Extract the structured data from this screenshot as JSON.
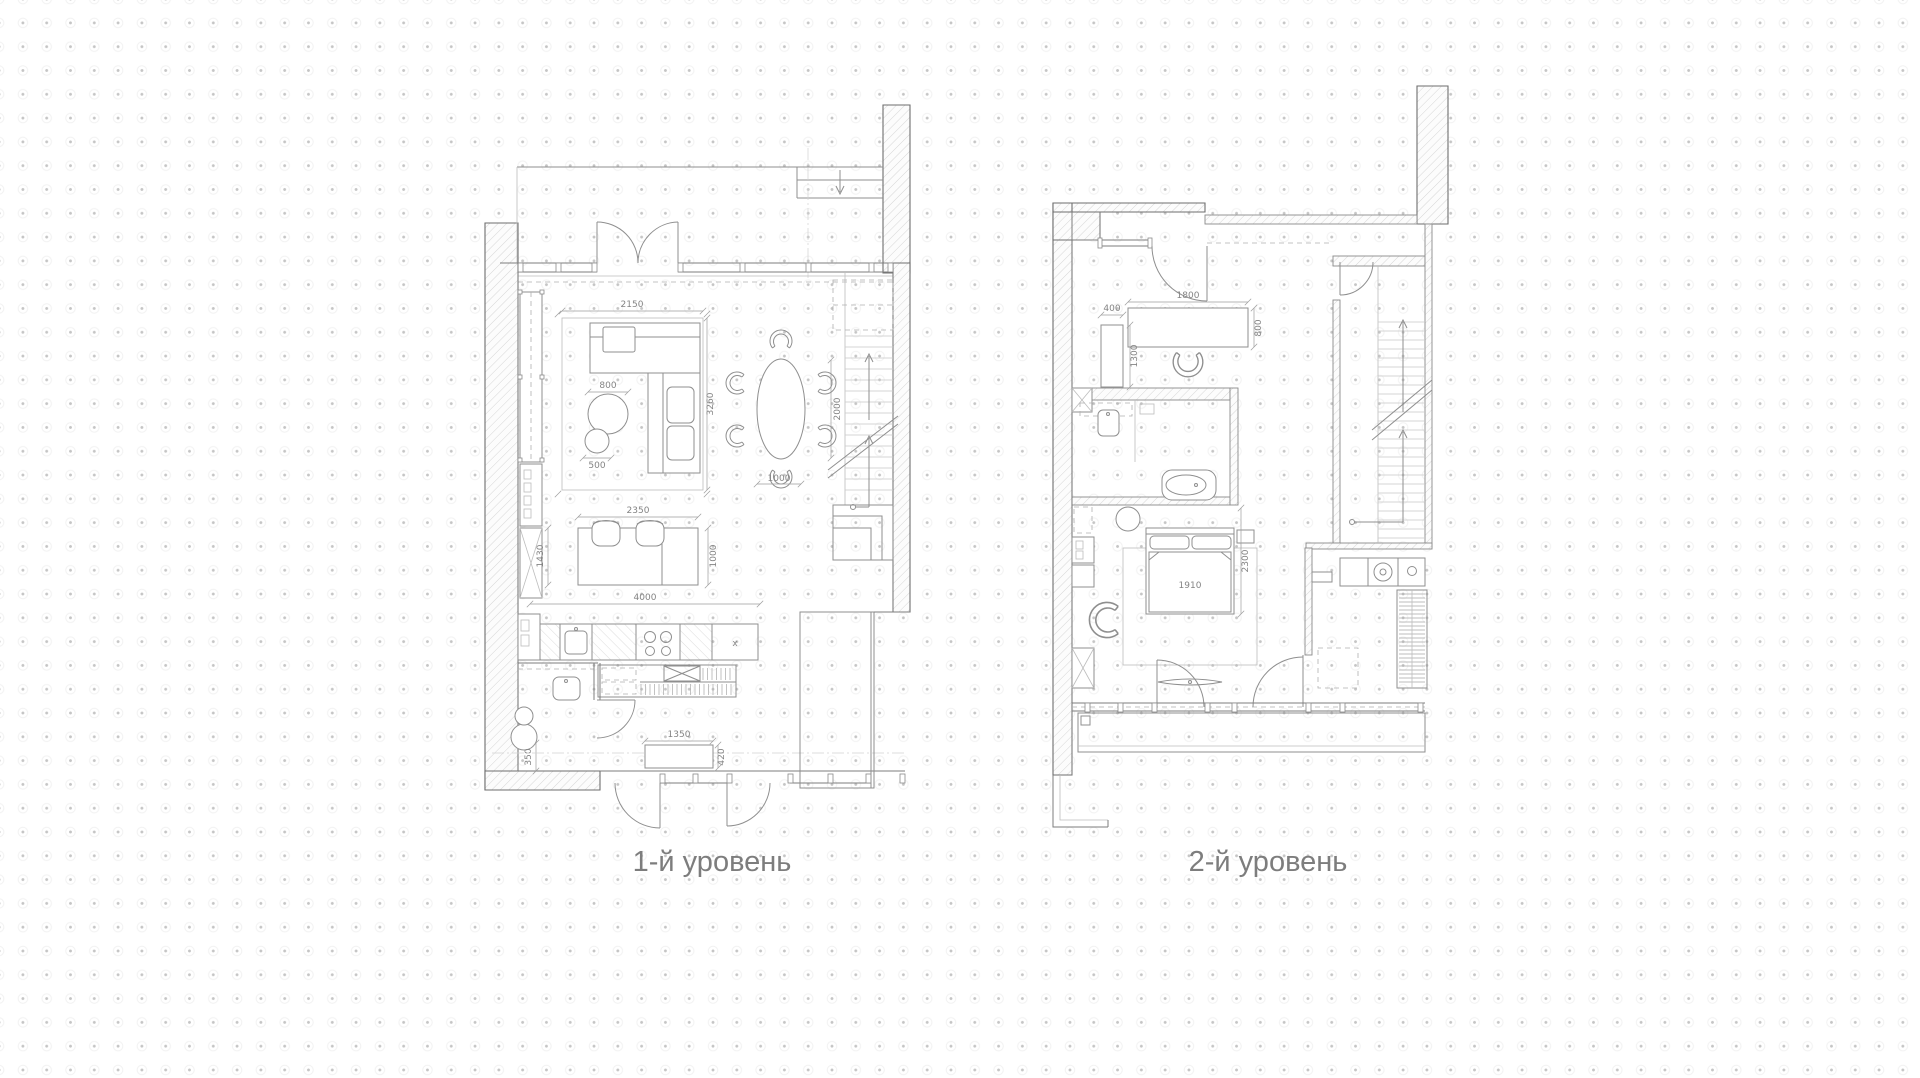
{
  "palette": {
    "background": "#ffffff",
    "grid_dot": "#c5c5c5",
    "wall_line": "#6e6e6e",
    "drawing_line": "#8f8f8f",
    "light_line": "#bdbdbd",
    "dim_text": "#848484",
    "label_text": "#7d7d7d"
  },
  "plans": [
    {
      "label": "1-й уровень",
      "dims": {
        "living_group_width": "2150",
        "coffee_table_large": "800",
        "coffee_table_small": "500",
        "living_group_depth": "3260",
        "dining_table_depth": "2000",
        "dining_clearance": "1000",
        "island_width": "2350",
        "island_depth": "1000",
        "aisle_width": "1430",
        "kitchen_run": "4000",
        "wc_clearance": "350",
        "bench_width": "1350",
        "bench_depth": "420",
        "counter_mark": "x"
      }
    },
    {
      "label": "2-й уровень",
      "dims": {
        "shelf_width": "400",
        "shelf_length": "1300",
        "desk_width": "1800",
        "desk_depth": "800",
        "bed_width": "1910",
        "bed_zone_depth": "2300"
      }
    }
  ]
}
